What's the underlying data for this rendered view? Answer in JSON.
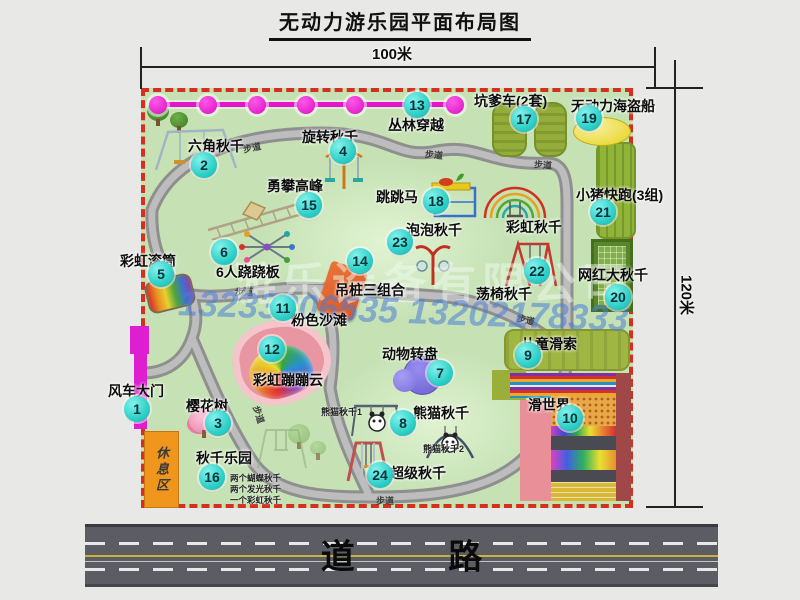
{
  "title": "无动力游乐园平面布局图",
  "dimensions": {
    "width": "100米",
    "height": "120米"
  },
  "road_label": "道 路",
  "path_label": "步道",
  "rest_area": "休息区",
  "watermark": {
    "company": "游乐设备有限公司",
    "phone": "13233806535 13202178333"
  },
  "extra_labels": {
    "rainbow_swing": "彩虹秋千",
    "panda_swing_1": "熊猫秋千1",
    "panda_swing_2": "熊猫秋千2"
  },
  "swing_park_notes": {
    "line1": "两个蝴蝶秋千",
    "line2": "两个发光秋千",
    "line3": "一个彩虹秋千"
  },
  "items": [
    {
      "num": "1",
      "label": "风车大门"
    },
    {
      "num": "2",
      "label": "六角秋千"
    },
    {
      "num": "3",
      "label": "樱花树"
    },
    {
      "num": "4",
      "label": "旋转秋千"
    },
    {
      "num": "5",
      "label": "彩虹滚筒"
    },
    {
      "num": "6",
      "label": "6人跷跷板"
    },
    {
      "num": "7",
      "label": "动物转盘"
    },
    {
      "num": "8",
      "label": "熊猫秋千"
    },
    {
      "num": "9",
      "label": "儿童滑索"
    },
    {
      "num": "10",
      "label": "滑世界"
    },
    {
      "num": "11",
      "label": "粉色沙滩"
    },
    {
      "num": "12",
      "label": "彩虹蹦蹦云"
    },
    {
      "num": "13",
      "label": "丛林穿越"
    },
    {
      "num": "14",
      "label": "吊桩三组合"
    },
    {
      "num": "15",
      "label": "勇攀高峰"
    },
    {
      "num": "16",
      "label": "秋千乐园"
    },
    {
      "num": "17",
      "label": "坑爹车(2套)"
    },
    {
      "num": "18",
      "label": "跳跳马"
    },
    {
      "num": "19",
      "label": "无动力海盗船"
    },
    {
      "num": "20",
      "label": "网红大秋千"
    },
    {
      "num": "21",
      "label": "小猪快跑(3组)"
    },
    {
      "num": "22",
      "label": "荡椅秋千"
    },
    {
      "num": "23",
      "label": "泡泡秋千"
    },
    {
      "num": "24",
      "label": "超级秋千"
    }
  ],
  "colors": {
    "map_green": "#c6e2b5",
    "border_red": "#d3301f",
    "badge_cyan": "#2ed0c8",
    "magenta": "#e515cb",
    "rest_orange": "#f0961c",
    "road_gray": "#5c5c64"
  }
}
